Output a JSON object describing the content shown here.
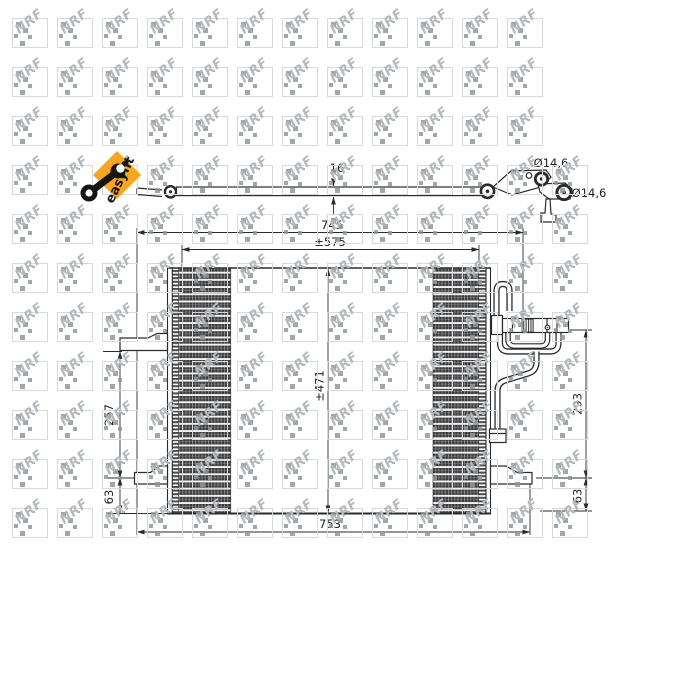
{
  "image_type": "catalog technical drawing of automotive AC condenser",
  "watermark": {
    "text": "NRF"
  },
  "badge": {
    "label": "easyfit"
  },
  "dimensions": {
    "top_width": "745",
    "core_width": "±575",
    "core_height": "±471",
    "overall_width": "753",
    "left_upper_height": "257",
    "left_lower_height": "63",
    "right_upper_height": "293",
    "right_lower_height": "63",
    "depth": "16",
    "port_diameter_top": "Ø14,6",
    "port_diameter_bottom": "Ø14,6"
  },
  "colors": {
    "line": "#2b2b2b",
    "easyfit_orange": "#F7A61E",
    "watermark_gray": "#b3b9bd",
    "fin_dark": "#3b3b3b"
  }
}
